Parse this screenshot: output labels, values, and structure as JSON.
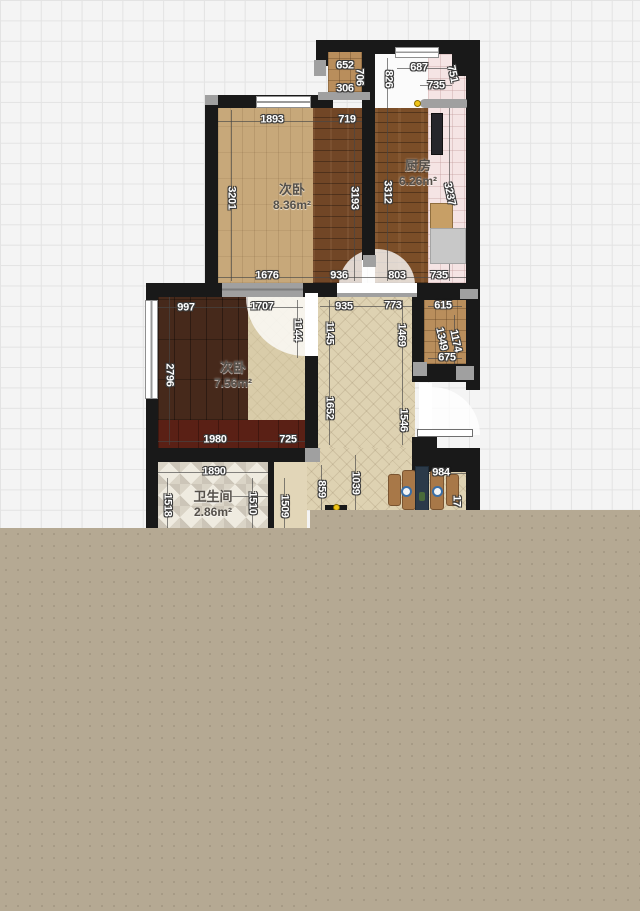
{
  "canvas": {
    "width": 640,
    "height": 911
  },
  "colors": {
    "grid_bg": "#f4f4f4",
    "grid_line": "#e3e3e3",
    "wall": "#191919",
    "wall_gray": "#a0a0a0",
    "tan_overlay": "#b5a993",
    "dim_text": "#ffffff",
    "dim_outline": "#3a3a3a",
    "room_text": "#55504a",
    "accent_dot": "#f0c417",
    "light_wood": "#c7a87a",
    "dark_plank": "#714626",
    "kitchen_wood": "#7b4e28",
    "kitchen_tile": "#f5e4e4",
    "duct_wood": "#b98e5c",
    "herringbone": "#ded2b2",
    "bed_dark": "#46291b",
    "maroon": "#5a2015",
    "room2_light": "#d9cca9",
    "bath_tile": "#efebe0",
    "table_navy": "#2b3a49",
    "chair_wood": "#a87848"
  },
  "rooms": [
    {
      "name": "次卧",
      "area": "8.36m²",
      "x": 292,
      "y": 197
    },
    {
      "name": "厨房",
      "area": "6.26m²",
      "x": 418,
      "y": 173
    },
    {
      "name": "次卧",
      "area": "7.56m²",
      "x": 233,
      "y": 375
    },
    {
      "name": "卫生间",
      "area": "2.86m²",
      "x": 213,
      "y": 504
    }
  ],
  "dimension_labels": [
    {
      "text": "652",
      "x": 345,
      "y": 66,
      "rot": 0
    },
    {
      "text": "306",
      "x": 345,
      "y": 89,
      "rot": 0
    },
    {
      "text": "706",
      "x": 359,
      "y": 77,
      "rot": 90
    },
    {
      "text": "826",
      "x": 388,
      "y": 79,
      "rot": 90
    },
    {
      "text": "687",
      "x": 419,
      "y": 68,
      "rot": 0
    },
    {
      "text": "751",
      "x": 452,
      "y": 74,
      "rot": 78
    },
    {
      "text": "735",
      "x": 436,
      "y": 86,
      "rot": 0
    },
    {
      "text": "1893",
      "x": 272,
      "y": 120,
      "rot": 0
    },
    {
      "text": "719",
      "x": 347,
      "y": 120,
      "rot": 0
    },
    {
      "text": "3201",
      "x": 231,
      "y": 198,
      "rot": 90
    },
    {
      "text": "3193",
      "x": 354,
      "y": 198,
      "rot": 90
    },
    {
      "text": "3312",
      "x": 387,
      "y": 192,
      "rot": 90
    },
    {
      "text": "3237",
      "x": 449,
      "y": 194,
      "rot": 78
    },
    {
      "text": "1676",
      "x": 267,
      "y": 276,
      "rot": 0
    },
    {
      "text": "936",
      "x": 339,
      "y": 276,
      "rot": 0
    },
    {
      "text": "803",
      "x": 397,
      "y": 276,
      "rot": 0
    },
    {
      "text": "735",
      "x": 439,
      "y": 276,
      "rot": 0
    },
    {
      "text": "997",
      "x": 186,
      "y": 308,
      "rot": 0
    },
    {
      "text": "1707",
      "x": 262,
      "y": 307,
      "rot": 0
    },
    {
      "text": "935",
      "x": 344,
      "y": 307,
      "rot": 0
    },
    {
      "text": "773",
      "x": 393,
      "y": 306,
      "rot": 0
    },
    {
      "text": "615",
      "x": 443,
      "y": 306,
      "rot": 0
    },
    {
      "text": "1144",
      "x": 297,
      "y": 330,
      "rot": 90
    },
    {
      "text": "1145",
      "x": 329,
      "y": 333,
      "rot": 90
    },
    {
      "text": "1469",
      "x": 401,
      "y": 335,
      "rot": 90
    },
    {
      "text": "1349",
      "x": 441,
      "y": 339,
      "rot": 78
    },
    {
      "text": "1174",
      "x": 455,
      "y": 341,
      "rot": 78
    },
    {
      "text": "675",
      "x": 447,
      "y": 358,
      "rot": 0
    },
    {
      "text": "2796",
      "x": 169,
      "y": 375,
      "rot": 90
    },
    {
      "text": "1652",
      "x": 329,
      "y": 408,
      "rot": 90
    },
    {
      "text": "1546",
      "x": 403,
      "y": 420,
      "rot": 90
    },
    {
      "text": "1980",
      "x": 215,
      "y": 440,
      "rot": 0
    },
    {
      "text": "725",
      "x": 288,
      "y": 440,
      "rot": 0
    },
    {
      "text": "1890",
      "x": 214,
      "y": 472,
      "rot": 0
    },
    {
      "text": "1518",
      "x": 167,
      "y": 505,
      "rot": 90
    },
    {
      "text": "1510",
      "x": 252,
      "y": 503,
      "rot": 90
    },
    {
      "text": "1509",
      "x": 284,
      "y": 506,
      "rot": 90
    },
    {
      "text": "859",
      "x": 321,
      "y": 489,
      "rot": 90
    },
    {
      "text": "1039",
      "x": 355,
      "y": 483,
      "rot": 90
    },
    {
      "text": "984",
      "x": 441,
      "y": 473,
      "rot": 0
    },
    {
      "text": "17",
      "x": 456,
      "y": 501,
      "rot": 90
    }
  ]
}
